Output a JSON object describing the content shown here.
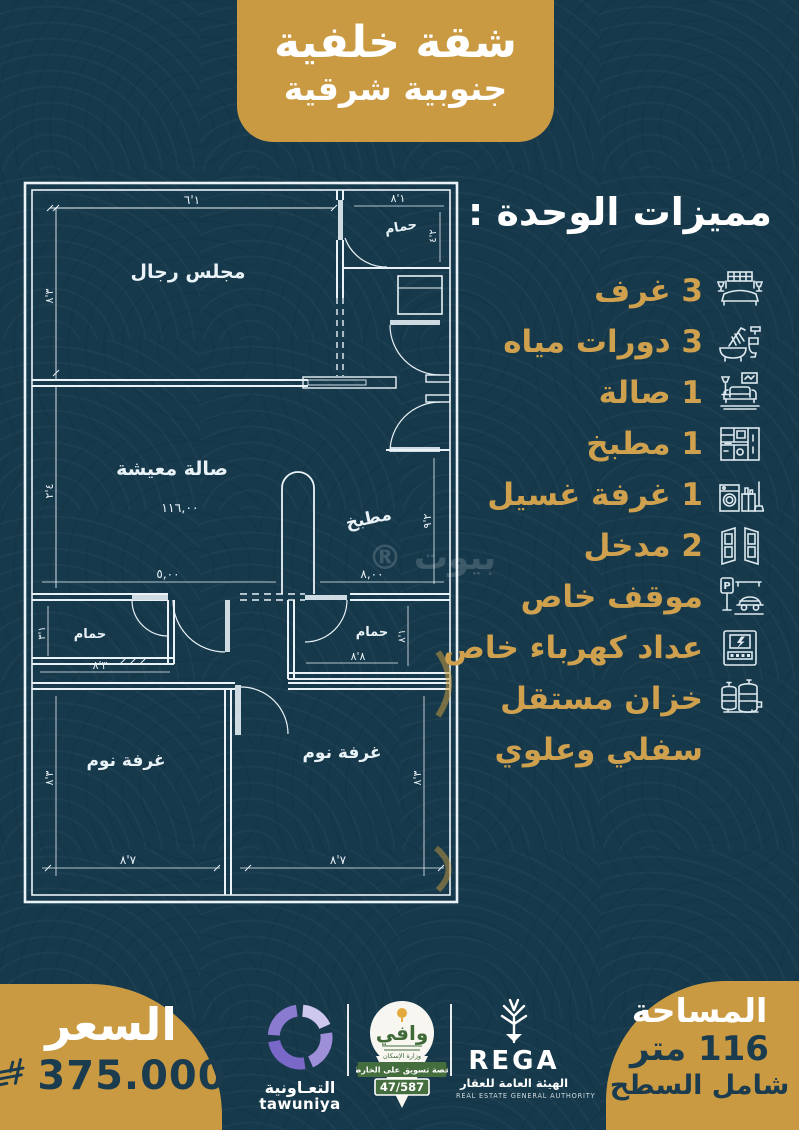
{
  "header_badge": {
    "line1": "شقة خلفية",
    "line2": "جنوبية شرقية"
  },
  "features": {
    "title": "مميزات الوحدة :",
    "parking_letter": "P",
    "items": [
      {
        "label": "3 غرف",
        "icon": "bed-icon"
      },
      {
        "label": "3 دورات مياه",
        "icon": "bathroom-icon"
      },
      {
        "label": "1 صالة",
        "icon": "sofa-icon"
      },
      {
        "label": "1 مطبخ",
        "icon": "kitchen-icon"
      },
      {
        "label": "1 غرفة غسيل",
        "icon": "washing-machine-icon"
      },
      {
        "label": "2 مدخل",
        "icon": "doors-icon"
      },
      {
        "label": "موقف خاص",
        "icon": "parking-icon"
      },
      {
        "label": "عداد كهرباء خاص",
        "icon": "electric-meter-icon"
      },
      {
        "label": "خزان مستقل",
        "icon": "water-tank-icon"
      },
      {
        "label": "سفلي وعلوي",
        "icon": null
      }
    ]
  },
  "floor_plan": {
    "watermark": "بيوت ®",
    "rooms": {
      "majlis": "مجلس رجال",
      "living": "صالة معيشة",
      "kitchen": "مطبخ",
      "bathroom": "حمام",
      "bedroom": "غرفة نوم"
    },
    "dims": {
      "majlis_w": "١'٦",
      "majlis_h": "٣'٨",
      "living_h": "٤'٢",
      "living_area": "١١٦,٠٠",
      "bath_top_w": "١'٨",
      "bath_top_h": "٢'٤",
      "kitchen_h": "٢'٩",
      "hall_w_left": "٥,٠٠",
      "hall_w_right": "٨,٠٠",
      "bath_left_h": "١'٣",
      "bath_left_w": "٣'٨",
      "bath_right_w": "٨'٨",
      "bath_right_h": "١'٨",
      "bed_left_h": "٣'٨",
      "bed_left_w": "٧'٨",
      "bed_right_h": "٣'٨",
      "bed_right_w": "٧'٨"
    }
  },
  "price_badge": {
    "title": "السعر",
    "value": "375.000"
  },
  "area_badge": {
    "title": "المساحة",
    "value": "116 متر",
    "note": "شامل السطح"
  },
  "logos": {
    "tawuniya": {
      "arabic": "التعـاونية",
      "latin": "tawuniya"
    },
    "wafi": {
      "name": "وافي",
      "ministry": "وزارة الإسكان",
      "license_text": "رخصة تسويق على الخارطة",
      "license_number": "47/587"
    },
    "rega": {
      "name": "REGA",
      "arabic": "الهيئة العامة للعقار",
      "english": "REAL ESTATE GENERAL AUTHORITY"
    }
  },
  "colors": {
    "background": "#16394b",
    "gold": "#CA9A43",
    "feature_text": "#CFA14E",
    "dark_text": "#1B3B4E",
    "blueprint_line": "#E9F2F7",
    "tawuniya_purple": "#7a68c8",
    "wafi_green": "#456e3e"
  }
}
